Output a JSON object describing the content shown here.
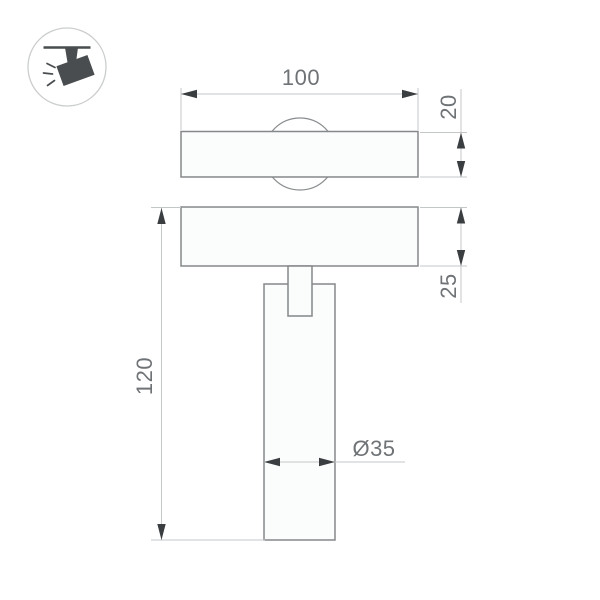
{
  "icon": {
    "name": "track-spotlight-icon"
  },
  "dimensions": {
    "width": "100",
    "track_body_height": "20",
    "plate_height": "25",
    "overall_height": "120",
    "diameter": "Ø35"
  },
  "colors": {
    "outline": "#85888a",
    "dimension_line": "#c4c7c8",
    "arrow": "#3a3e40",
    "label": "#6f7376",
    "icon": "#494d4f",
    "icon_circle": "#cbcdce",
    "background": "#ffffff"
  }
}
